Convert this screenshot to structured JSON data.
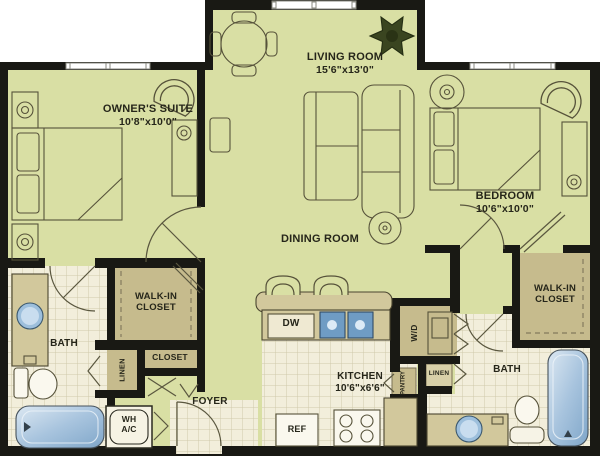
{
  "labels": {
    "owners_suite": {
      "line1": "OWNER'S SUITE",
      "line2": "10'8\"x10'0\""
    },
    "living_room": {
      "line1": "LIVING ROOM",
      "line2": "15'6\"x13'0\""
    },
    "bedroom": {
      "line1": "BEDROOM",
      "line2": "10'6\"x10'0\""
    },
    "dining_room": {
      "line1": "DINING ROOM"
    },
    "kitchen": {
      "line1": "KITCHEN",
      "line2": "10'6\"x6'6\""
    },
    "foyer": {
      "line1": "FOYER"
    },
    "bath_left": {
      "line1": "BATH"
    },
    "bath_right": {
      "line1": "BATH"
    },
    "walk_in_left": {
      "line1": "WALK-IN",
      "line2": "CLOSET"
    },
    "walk_in_right": {
      "line1": "WALK-IN",
      "line2": "CLOSET"
    },
    "closet": {
      "line1": "CLOSET"
    },
    "linen_left": {
      "line1": "LINEN"
    },
    "linen_right": {
      "line1": "LINEN"
    },
    "pantry": {
      "line1": "PANTRY"
    },
    "washer_dryer": {
      "line1": "W/D"
    },
    "water_heater_ac": {
      "line1": "WH",
      "line2": "A/C"
    },
    "dishwasher": {
      "line1": "DW"
    },
    "refrigerator": {
      "line1": "REF"
    }
  },
  "colors": {
    "wall": "#191914",
    "floor": "#d9dfa4",
    "closet_tan": "#c6bb8d",
    "counter_tan": "#d2c89c",
    "tile": "#f2eedb",
    "tub_blue": "#8fb3d3",
    "sink_blue": "#6f9cc4",
    "plant_green": "#3a4520",
    "text": "#26261a"
  }
}
